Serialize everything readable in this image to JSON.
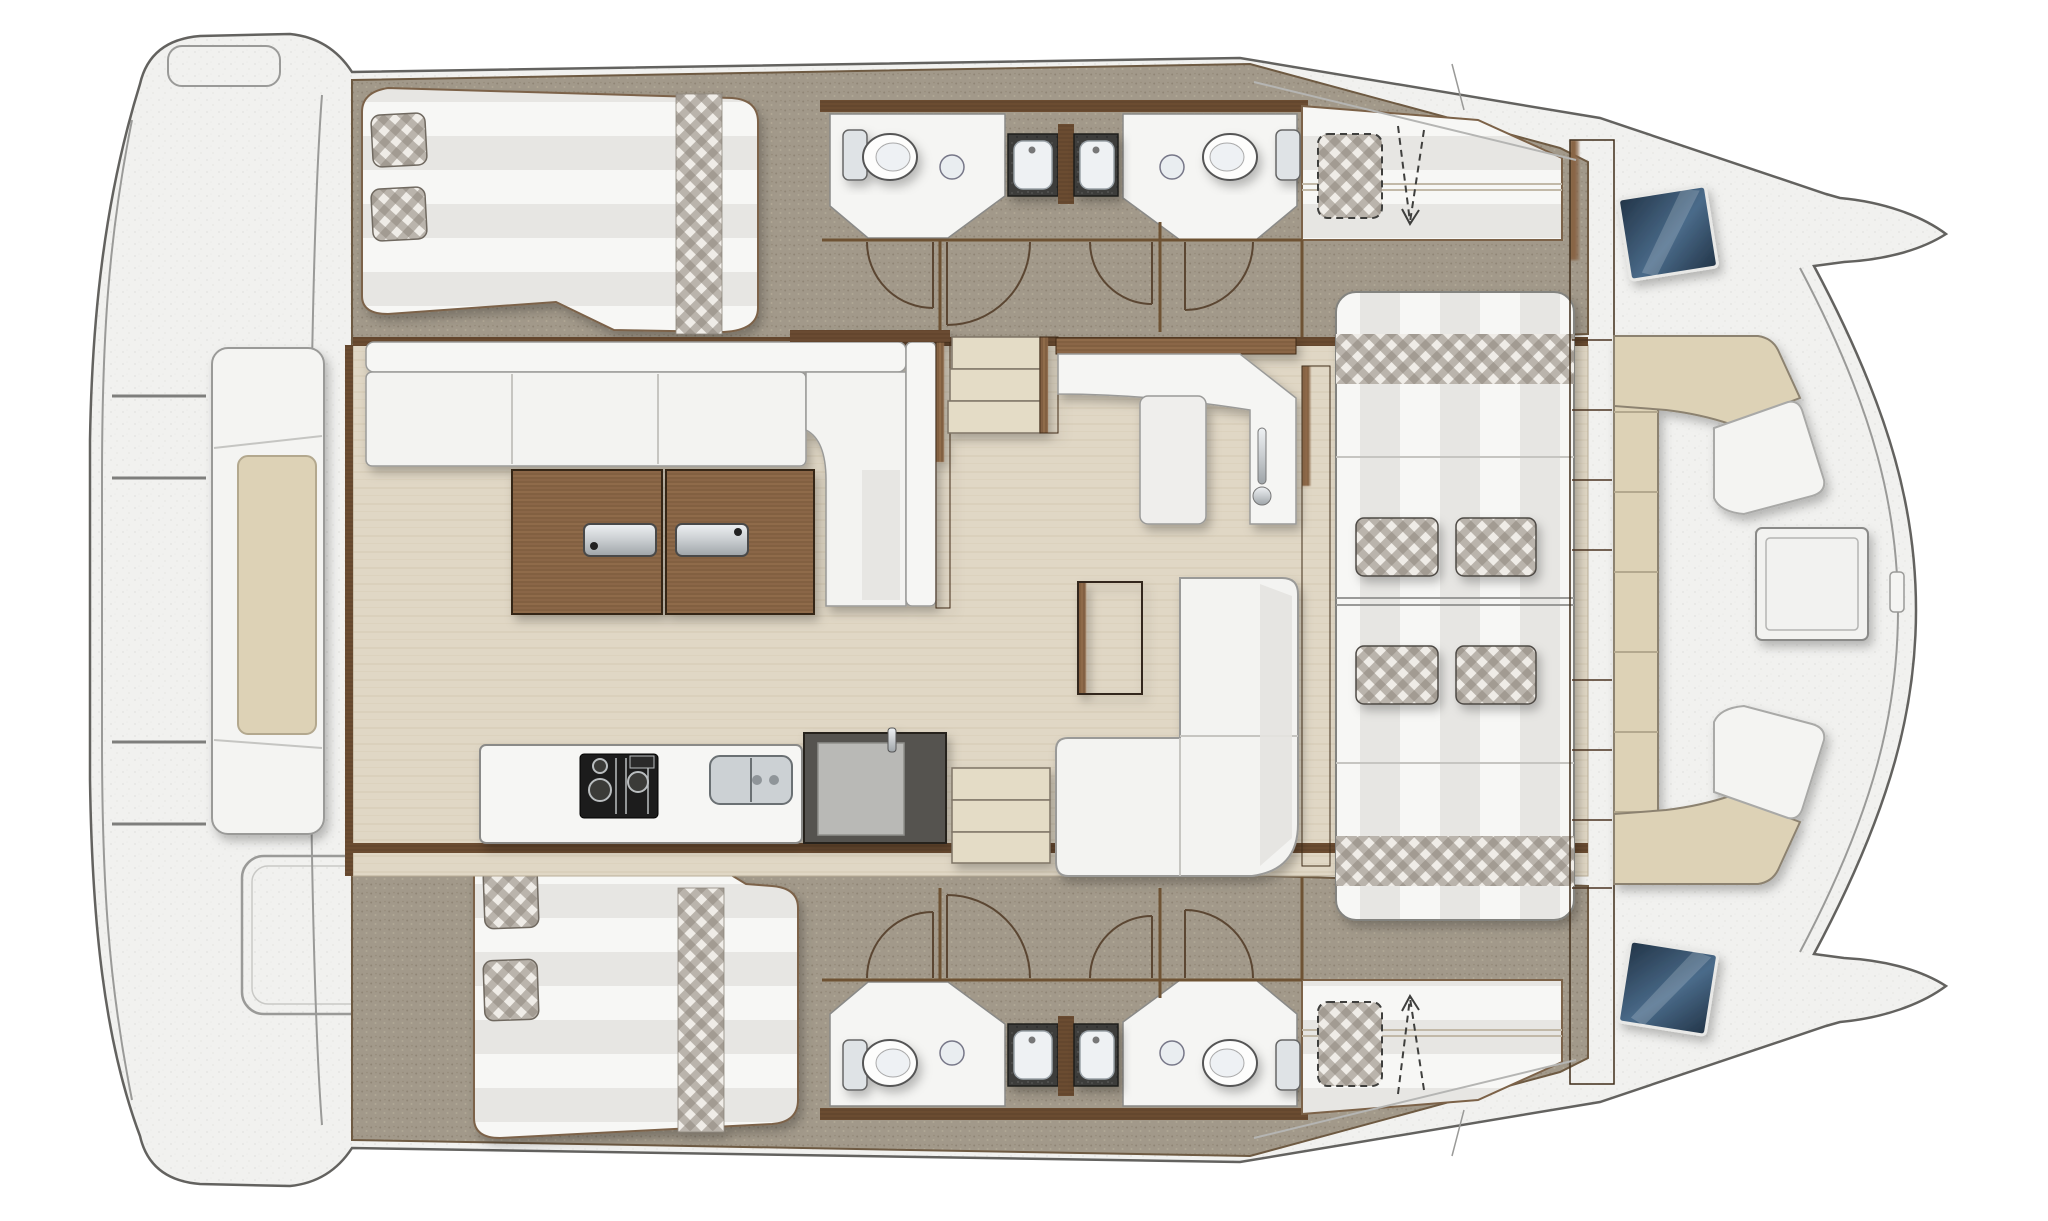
{
  "page": {
    "background": "#ffffff"
  },
  "diagram": {
    "type": "floor-plan",
    "subject": "catamaran-yacht-interior-deck-plan",
    "orientation": {
      "view": "top-down",
      "bow": "right",
      "stern": "left"
    },
    "symmetry": "mirrored-about-centerline",
    "counts": {
      "double_beds": 2,
      "optional_berths": 2,
      "toilets": 4,
      "vanity_basins": 4,
      "round_washbasins": 4,
      "dinette_stools": 4,
      "companionway_step_sets": 2,
      "glass_hatches": 2,
      "door_swings": 8
    },
    "colors": {
      "outline": "#63625f",
      "deck": "#f1f1ef",
      "deck_line": "#9a9a98",
      "carpet": "#a2998a",
      "carpet_edge": "#6e5a42",
      "salon_floor": "#e0d7c5",
      "wood": "#8a6647",
      "wood_dark": "#6b4c31",
      "upholstery": "#f3f3f1",
      "upholstery_shade": "#e4e3e0",
      "cushion_beige": "#ddd2b6",
      "plaid_base": "#efece7",
      "plaid_gray": "#8d867c",
      "counter_dark": "#3c3c3a",
      "appliance_dark": "#55534f",
      "chrome": "#c9cdd0",
      "glass_blue_dark": "#223447",
      "glass_blue": "#4a6b8a",
      "step_beige": "#e4dcc6",
      "stripe_light": "#f7f7f5",
      "stripe_dark": "#e7e6e3",
      "white_fixture": "#f5f5f3"
    },
    "areas": [
      "aft-deck",
      "main-salon",
      "galley",
      "navigation-corner",
      "dinette",
      "hull-cabin-top",
      "hull-corridor-top",
      "bathrooms-top",
      "optional-berth-top",
      "hull-cabin-bottom",
      "hull-corridor-bottom",
      "bathrooms-bottom",
      "optional-berth-bottom",
      "forward-cockpit",
      "foredeck"
    ],
    "furniture": [
      "aft-bench",
      "deck-hatch-outline",
      "corner-locker",
      "l-shaped-settee",
      "folding-table-with-handles",
      "galley-counter",
      "gas-stove",
      "double-sink",
      "refrigerator",
      "companionway-steps",
      "chart-counter",
      "counter-module",
      "door-handle",
      "lounge-sofa",
      "coffee-table",
      "dinette-table",
      "dinette-end-bench",
      "plaid-stool",
      "double-bed",
      "plaid-pillow",
      "plaid-runner",
      "toilet",
      "vanity-counter",
      "washbasin",
      "optional-berth-cushion",
      "u-shaped-bow-seating",
      "backrest-wedge",
      "bow-table",
      "glass-hatch",
      "bulkhead-shelves"
    ]
  }
}
